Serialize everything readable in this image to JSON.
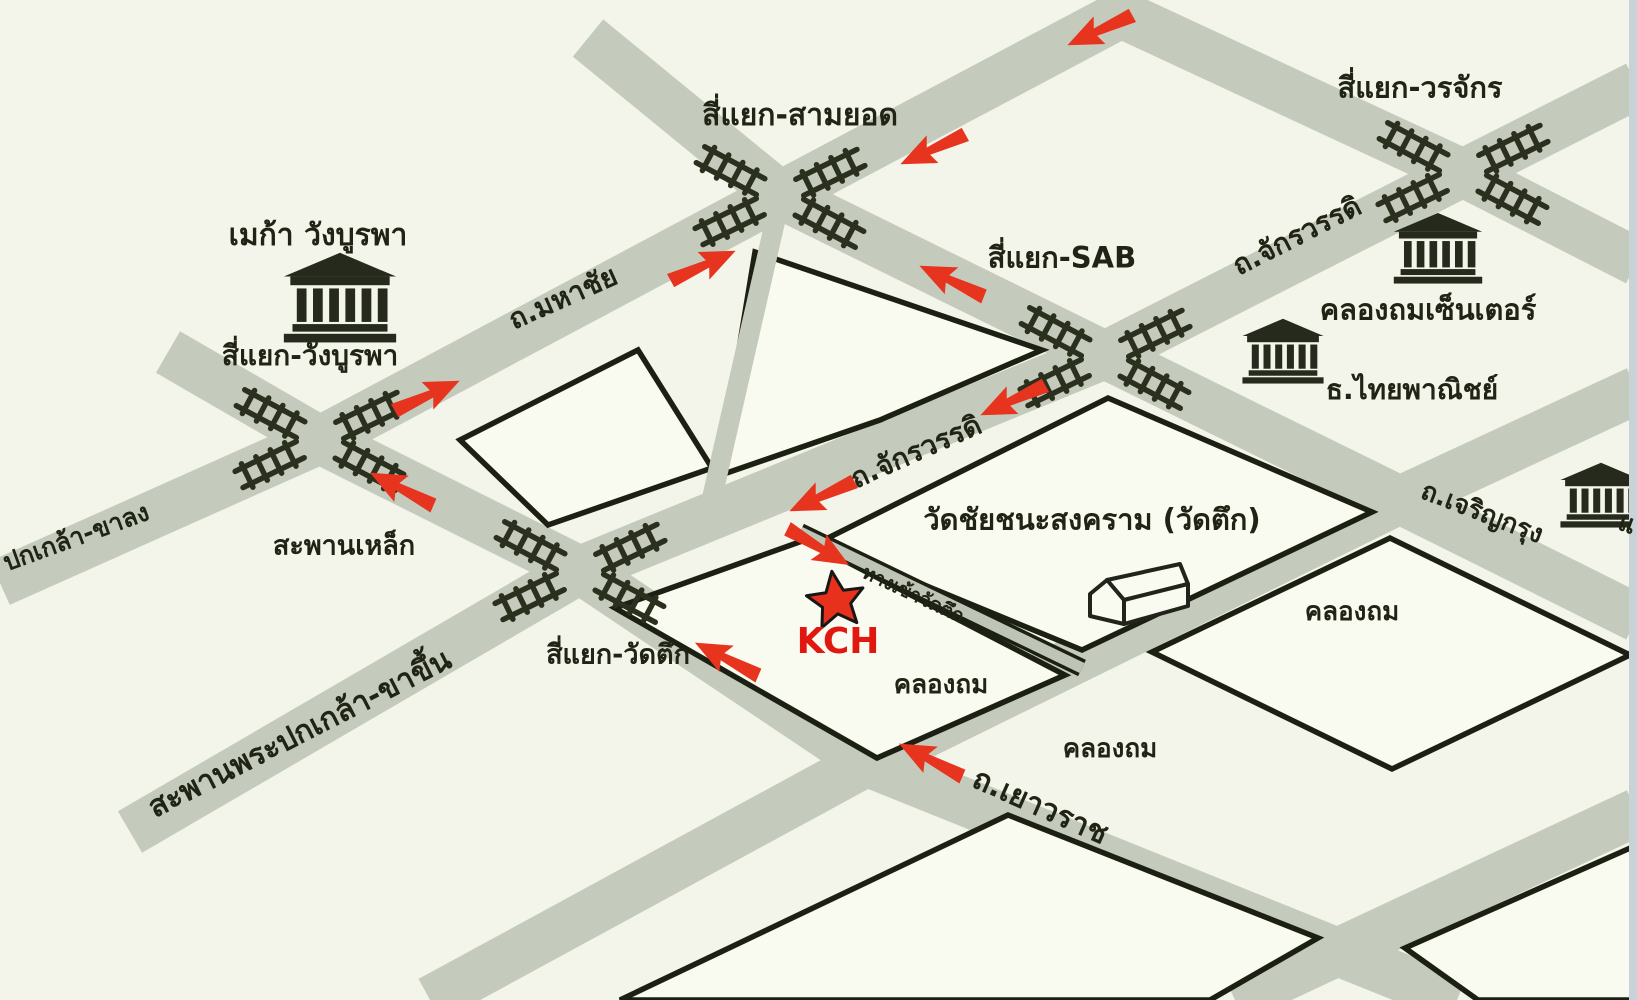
{
  "map_name": "KCH location map (Khlong Thom / Wat Tuek area)",
  "colors": {
    "background": "#f3f4ea",
    "road_gray": "#c5cbbc",
    "block_fill": "#f9faf0",
    "outline_black": "#1c2013",
    "text_dark": "#202415",
    "arrow_red": "#e6341f",
    "star_red": "#e8311c",
    "kch_red": "#e01810",
    "scan_edge": "#c9d2d8"
  },
  "star_marker": {
    "label": "KCH",
    "x": 836,
    "y": 601,
    "label_x": 838,
    "label_y": 642
  },
  "labels": [
    {
      "id": "label-samyot",
      "text": "สี่แยก-สามยอด",
      "x": 800,
      "y": 116,
      "rot": 0,
      "size": 30
    },
    {
      "id": "label-worachak",
      "text": "สี่แยก-วรจักร",
      "x": 1420,
      "y": 88,
      "rot": 0,
      "size": 29
    },
    {
      "id": "label-mega-wangburapha",
      "text": "เมก้า วังบูรพา",
      "x": 318,
      "y": 236,
      "rot": 0,
      "size": 30
    },
    {
      "id": "label-wangburapha",
      "text": "สี่แยก-วังบูรพา",
      "x": 310,
      "y": 356,
      "rot": 0,
      "size": 28
    },
    {
      "id": "label-mahachai-rd",
      "text": "ถ.มหาชัย",
      "x": 563,
      "y": 298,
      "rot": -24,
      "size": 28
    },
    {
      "id": "label-sab",
      "text": "สี่แยก-SAB",
      "x": 1062,
      "y": 258,
      "rot": 0,
      "size": 29
    },
    {
      "id": "label-jakrawat-north",
      "text": "ถ.จักรวรรดิ",
      "x": 1297,
      "y": 236,
      "rot": -27,
      "size": 28
    },
    {
      "id": "label-klongthom-center",
      "text": "คลองถมเซ็นเตอร์",
      "x": 1428,
      "y": 310,
      "rot": 0,
      "size": 29
    },
    {
      "id": "label-scb-bank",
      "text": "ธ.ไทยพาณิชย์",
      "x": 1412,
      "y": 390,
      "rot": 0,
      "size": 28
    },
    {
      "id": "label-saphanlek",
      "text": "สะพานเหล็ก",
      "x": 344,
      "y": 546,
      "rot": 0,
      "size": 27
    },
    {
      "id": "label-jakrawat-south",
      "text": "ถ.จักรวรรดิ",
      "x": 916,
      "y": 452,
      "rot": -24,
      "size": 28
    },
    {
      "id": "label-wat-chaichana",
      "text": "วัดชัยชนะสงคราม (วัดตึก)",
      "x": 1092,
      "y": 520,
      "rot": 0,
      "size": 29
    },
    {
      "id": "label-klongthom-1",
      "text": "คลองถม",
      "x": 1352,
      "y": 612,
      "rot": 0,
      "size": 26
    },
    {
      "id": "label-entrance-wattuek",
      "text": "ทางเข้าวัดตึก",
      "x": 913,
      "y": 595,
      "rot": 25,
      "size": 19
    },
    {
      "id": "label-wattuek-junction",
      "text": "สี่แยก-วัดตึก",
      "x": 618,
      "y": 655,
      "rot": 0,
      "size": 27
    },
    {
      "id": "label-klongthom-2",
      "text": "คลองถม",
      "x": 941,
      "y": 685,
      "rot": 0,
      "size": 26
    },
    {
      "id": "label-klongthom-3",
      "text": "คลองถม",
      "x": 1110,
      "y": 749,
      "rot": 0,
      "size": 26
    },
    {
      "id": "label-pokklao-up",
      "text": "สะพานพระปกเกล้า-ขาขึ้น",
      "x": 300,
      "y": 734,
      "rot": -27,
      "size": 30
    },
    {
      "id": "label-pokklao-down",
      "text": "ปกเกล้า-ขาลง",
      "x": 76,
      "y": 537,
      "rot": -20,
      "size": 25
    },
    {
      "id": "label-yaowarat-rd",
      "text": "ถ.เยาวราช",
      "x": 1040,
      "y": 807,
      "rot": 24,
      "size": 30
    },
    {
      "id": "label-charoenkrung-rd",
      "text": "ถ.เจริญกรุง",
      "x": 1482,
      "y": 513,
      "rot": 21,
      "size": 26
    },
    {
      "id": "label-edge-partial",
      "text": "แ",
      "x": 1627,
      "y": 524,
      "rot": 20,
      "size": 26
    }
  ],
  "arrows": [
    {
      "id": "arrow-mahachai-top",
      "x": 1100,
      "y": 30,
      "angle": 155
    },
    {
      "id": "arrow-mahachai-upper",
      "x": 933,
      "y": 149,
      "angle": 155
    },
    {
      "id": "arrow-mahachai-mid",
      "x": 703,
      "y": 266,
      "angle": -25
    },
    {
      "id": "arrow-mahachai-lower",
      "x": 427,
      "y": 396,
      "angle": -25
    },
    {
      "id": "arrow-saphanlek",
      "x": 402,
      "y": 489,
      "angle": 207
    },
    {
      "id": "arrow-samyot-sab",
      "x": 952,
      "y": 281,
      "angle": 205
    },
    {
      "id": "arrow-jakrawat-upper",
      "x": 1013,
      "y": 400,
      "angle": 155
    },
    {
      "id": "arrow-jakrawat-lower",
      "x": 822,
      "y": 496,
      "angle": 155
    },
    {
      "id": "arrow-entrance",
      "x": 818,
      "y": 547,
      "angle": 30
    },
    {
      "id": "arrow-yaowarat-west",
      "x": 727,
      "y": 659,
      "angle": 207
    },
    {
      "id": "arrow-yaowarat-east",
      "x": 931,
      "y": 760,
      "angle": 207
    }
  ],
  "railroad_crossings": [
    {
      "id": "crossing-samyot",
      "x": 780,
      "y": 197
    },
    {
      "id": "crossing-worachak",
      "x": 1463,
      "y": 173
    },
    {
      "id": "crossing-wangburapha",
      "x": 320,
      "y": 440
    },
    {
      "id": "crossing-sab",
      "x": 1105,
      "y": 358
    },
    {
      "id": "crossing-wattuek",
      "x": 580,
      "y": 572
    }
  ],
  "buildings": [
    {
      "id": "bank-icon-wangburapha",
      "type": "bank",
      "x": 340,
      "y": 296,
      "scale": 1.08
    },
    {
      "id": "bank-icon-klongthomcenter",
      "type": "bank",
      "x": 1438,
      "y": 247,
      "scale": 0.85
    },
    {
      "id": "bank-icon-scb",
      "type": "bank",
      "x": 1283,
      "y": 350,
      "scale": 0.78
    },
    {
      "id": "bank-icon-right-edge",
      "type": "bank",
      "x": 1601,
      "y": 494,
      "scale": 0.78
    },
    {
      "id": "temple-icon-wattuek",
      "type": "temple",
      "x": 1140,
      "y": 582,
      "scale": 1.0
    }
  ]
}
